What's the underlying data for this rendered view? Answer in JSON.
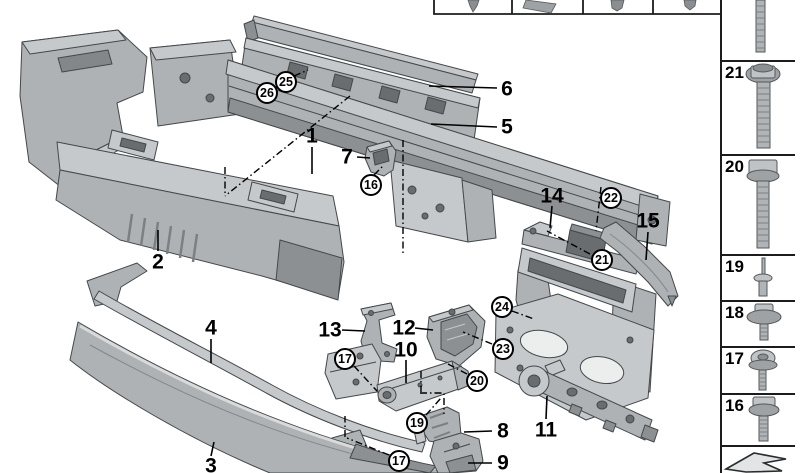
{
  "diagram": {
    "name": "Front bumper carrier exploded parts diagram",
    "background": "#ffffff",
    "part_fill": "#aeb2b4",
    "outline_color": "#43484b",
    "line_color": "#000000"
  },
  "callouts": {
    "plain": [
      {
        "label": "1",
        "x": 312,
        "y": 136
      },
      {
        "label": "2",
        "x": 158,
        "y": 262
      },
      {
        "label": "3",
        "x": 211,
        "y": 466
      },
      {
        "label": "4",
        "x": 211,
        "y": 328
      },
      {
        "label": "5",
        "x": 507,
        "y": 127
      },
      {
        "label": "6",
        "x": 507,
        "y": 89
      },
      {
        "label": "7",
        "x": 347,
        "y": 157
      },
      {
        "label": "8",
        "x": 503,
        "y": 431
      },
      {
        "label": "9",
        "x": 503,
        "y": 463
      },
      {
        "label": "10",
        "x": 406,
        "y": 350
      },
      {
        "label": "11",
        "x": 546,
        "y": 430
      },
      {
        "label": "12",
        "x": 404,
        "y": 328
      },
      {
        "label": "13",
        "x": 330,
        "y": 330
      },
      {
        "label": "14",
        "x": 552,
        "y": 196
      },
      {
        "label": "15",
        "x": 648,
        "y": 221
      }
    ],
    "circled": [
      {
        "label": "16",
        "x": 371,
        "y": 185
      },
      {
        "label": "17",
        "x": 345,
        "y": 359
      },
      {
        "label": "17",
        "x": 399,
        "y": 461
      },
      {
        "label": "19",
        "x": 417,
        "y": 423
      },
      {
        "label": "20",
        "x": 477,
        "y": 381
      },
      {
        "label": "21",
        "x": 602,
        "y": 260
      },
      {
        "label": "22",
        "x": 611,
        "y": 198
      },
      {
        "label": "23",
        "x": 503,
        "y": 349
      },
      {
        "label": "24",
        "x": 502,
        "y": 307
      },
      {
        "label": "25",
        "x": 286,
        "y": 82
      },
      {
        "label": "26",
        "x": 267,
        "y": 93
      }
    ]
  },
  "top_row": {
    "boxes": [
      {
        "icon": "blind-rivet-icon"
      },
      {
        "icon": "clip-nut-icon"
      },
      {
        "icon": "expanding-rivet-icon"
      },
      {
        "icon": "plastic-stud-icon"
      }
    ]
  },
  "sidebar": {
    "items": [
      {
        "label": "",
        "icon": "threaded-rod-icon"
      },
      {
        "label": "21",
        "icon": "hex-flange-bolt-icon"
      },
      {
        "label": "20",
        "icon": "hex-bolt-icon"
      },
      {
        "label": "19",
        "icon": "blind-rivet-icon"
      },
      {
        "label": "18",
        "icon": "hex-washer-screw-icon"
      },
      {
        "label": "17",
        "icon": "pan-head-washer-screw-icon"
      },
      {
        "label": "16",
        "icon": "hex-flange-screw-icon"
      }
    ],
    "footer_icon": "direction-arrow-icon"
  }
}
